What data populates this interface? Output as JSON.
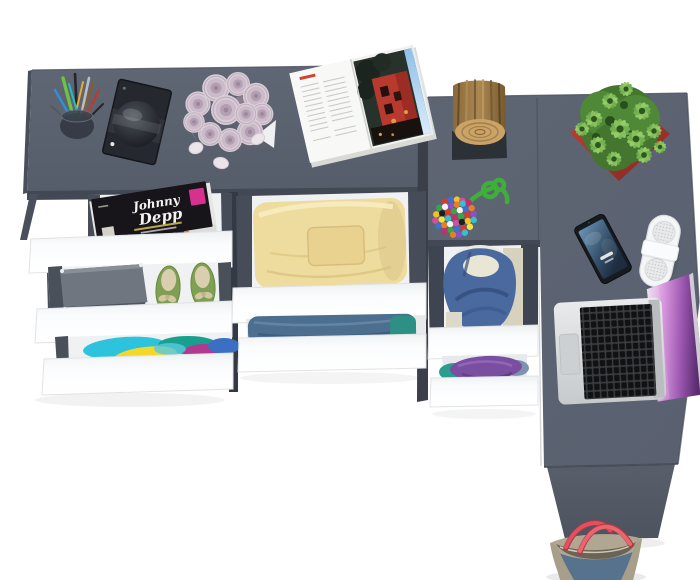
{
  "magazine_cover": {
    "title_line1": "Johnny",
    "title_line2": "Depp"
  },
  "colors": {
    "background": "#ffffff",
    "desk_top": "#5c6370",
    "desk_edge_dark": "#474d58",
    "leg_panel": "#535965",
    "drawer_front_white": "#fcfdfe",
    "drawer_interior": "#eff1f3",
    "magazine_badge_pink": "#d6318f",
    "shoe_green": "#7fa052",
    "shoe_bow_beige": "#d9cfae",
    "towel_yellow": "#eedc9e",
    "jeans_blue": "#4c6f90",
    "hoodie_blue": "#4a699e",
    "hoodie_lining_cream": "#e9e6d6",
    "shirt_purple": "#7b4fa0",
    "shirt_teal": "#2a9d8f",
    "clothes_cyan": "#2ec3dd",
    "clothes_yellow": "#f4d829",
    "clothes_magenta": "#b13a8e",
    "rose_pink": "#d9cdd7",
    "pot_red": "#b23b33",
    "plant_green": "#6fae4a",
    "stool_wood": "#a5824f",
    "cord_green": "#3fae3a",
    "phone_screen_blue": "#46698c",
    "speaker_white": "#f4f5f6",
    "laptop_silver": "#d6d8da",
    "laptop_screen_purple": "#9a55ae",
    "bag_denim": "#56728c",
    "bag_trim_khaki": "#b0a691",
    "bag_handle_red": "#e0505e"
  },
  "items": {
    "pen_cup": "pen cup with pens",
    "headphones_case": "dark case with headphones",
    "rose_bouquet": "bouquet of pale pink roses",
    "rose_petals": "loose rose petals",
    "open_magazine": "open magazine with city photo",
    "wood_stool": "log stool on dark mat",
    "candy_pouch": "bead pouch with green cord",
    "potted_plant": "succulent in red pot",
    "smartphone": "smartphone",
    "pill_speaker": "white portable speaker",
    "laptop": "open silver laptop",
    "tote_bag": "denim tote bag with red handles",
    "drawer_magazines": "open drawer with magazines",
    "drawer_shoes": "open drawer with shoe box and green flats",
    "drawer_clothes_colorful": "open drawer with colorful clothes",
    "drawer_towels_yellow": "open drawer with yellow folded clothes",
    "drawer_jeans": "open drawer with folded jeans",
    "drawer_hoodie": "open drawer with blue hoodie",
    "drawer_shirts_purple": "open drawer with purple and teal shirts"
  }
}
